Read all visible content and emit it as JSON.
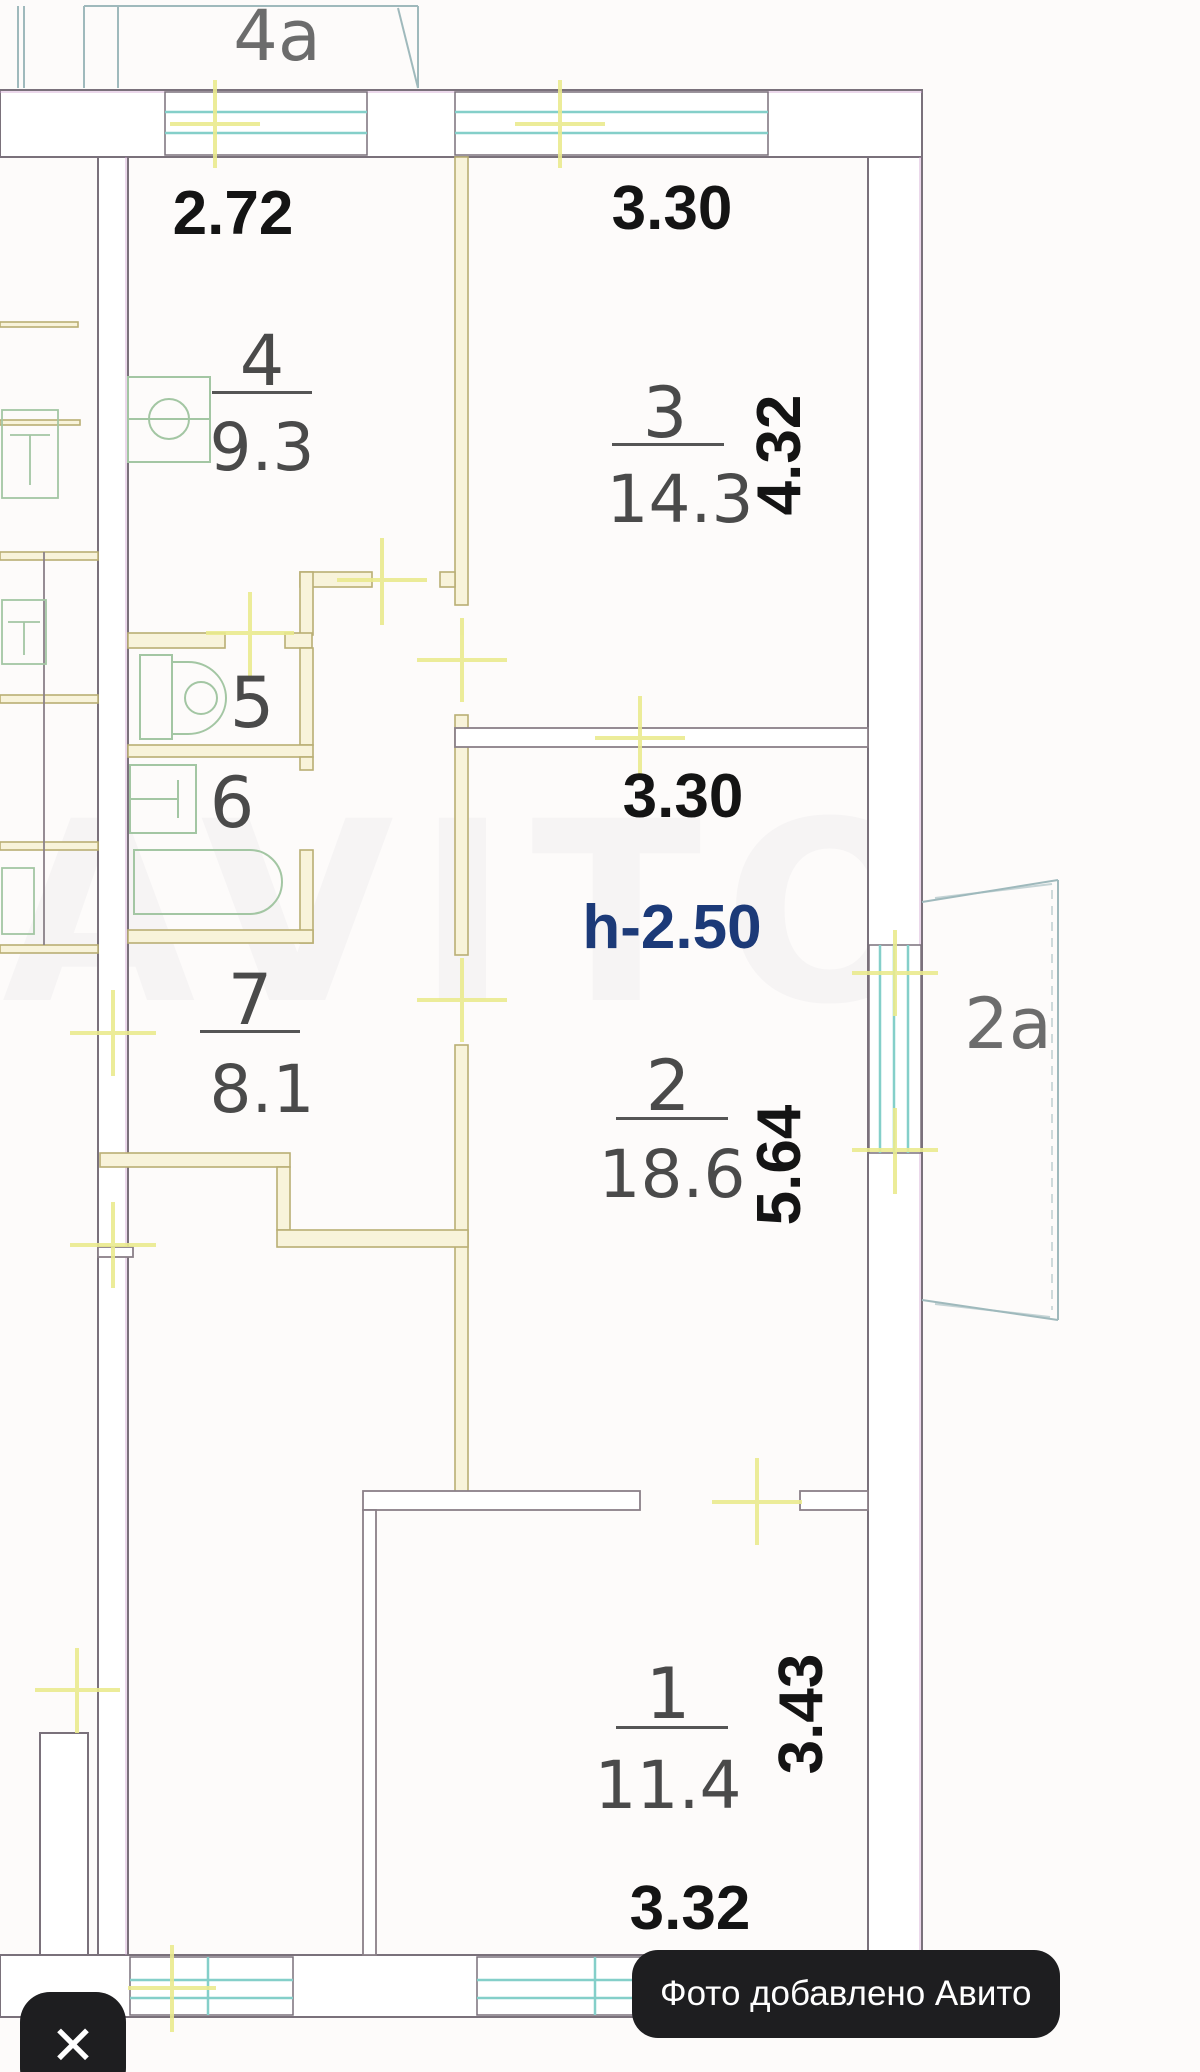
{
  "viewer": {
    "badge_text": "Фото добавлено Авито",
    "close_icon": "✕"
  },
  "plan": {
    "balcony_top_label": "4а",
    "balcony_right_label": "2а",
    "ceiling_height": "h-2.50",
    "watermark": "AVITO",
    "dimensions": {
      "kitchen_width": "2.72",
      "room3_width": "3.30",
      "room3_depth": "4.32",
      "room2_width": "3.30",
      "room2_depth": "5.64",
      "room1_depth": "3.43",
      "room1_width": "3.32"
    },
    "rooms": {
      "room1": {
        "number": "1",
        "area": "11.4"
      },
      "room2": {
        "number": "2",
        "area": "18.6"
      },
      "room3": {
        "number": "3",
        "area": "14.3"
      },
      "kitchen": {
        "number": "4",
        "area": "9.3"
      },
      "wc": {
        "number": "5"
      },
      "bathroom": {
        "number": "6"
      },
      "hall": {
        "number": "7",
        "area": "8.1"
      }
    },
    "colors": {
      "outer_wall": "#7a717b",
      "partition": "#b9ae74",
      "partition_fill": "#f8f3da",
      "window": "#84cfc9",
      "fixture": "#a3c6a3",
      "tick": "#eaea8e",
      "dimension_text": "#141414",
      "height_text": "#1c3a78"
    }
  }
}
